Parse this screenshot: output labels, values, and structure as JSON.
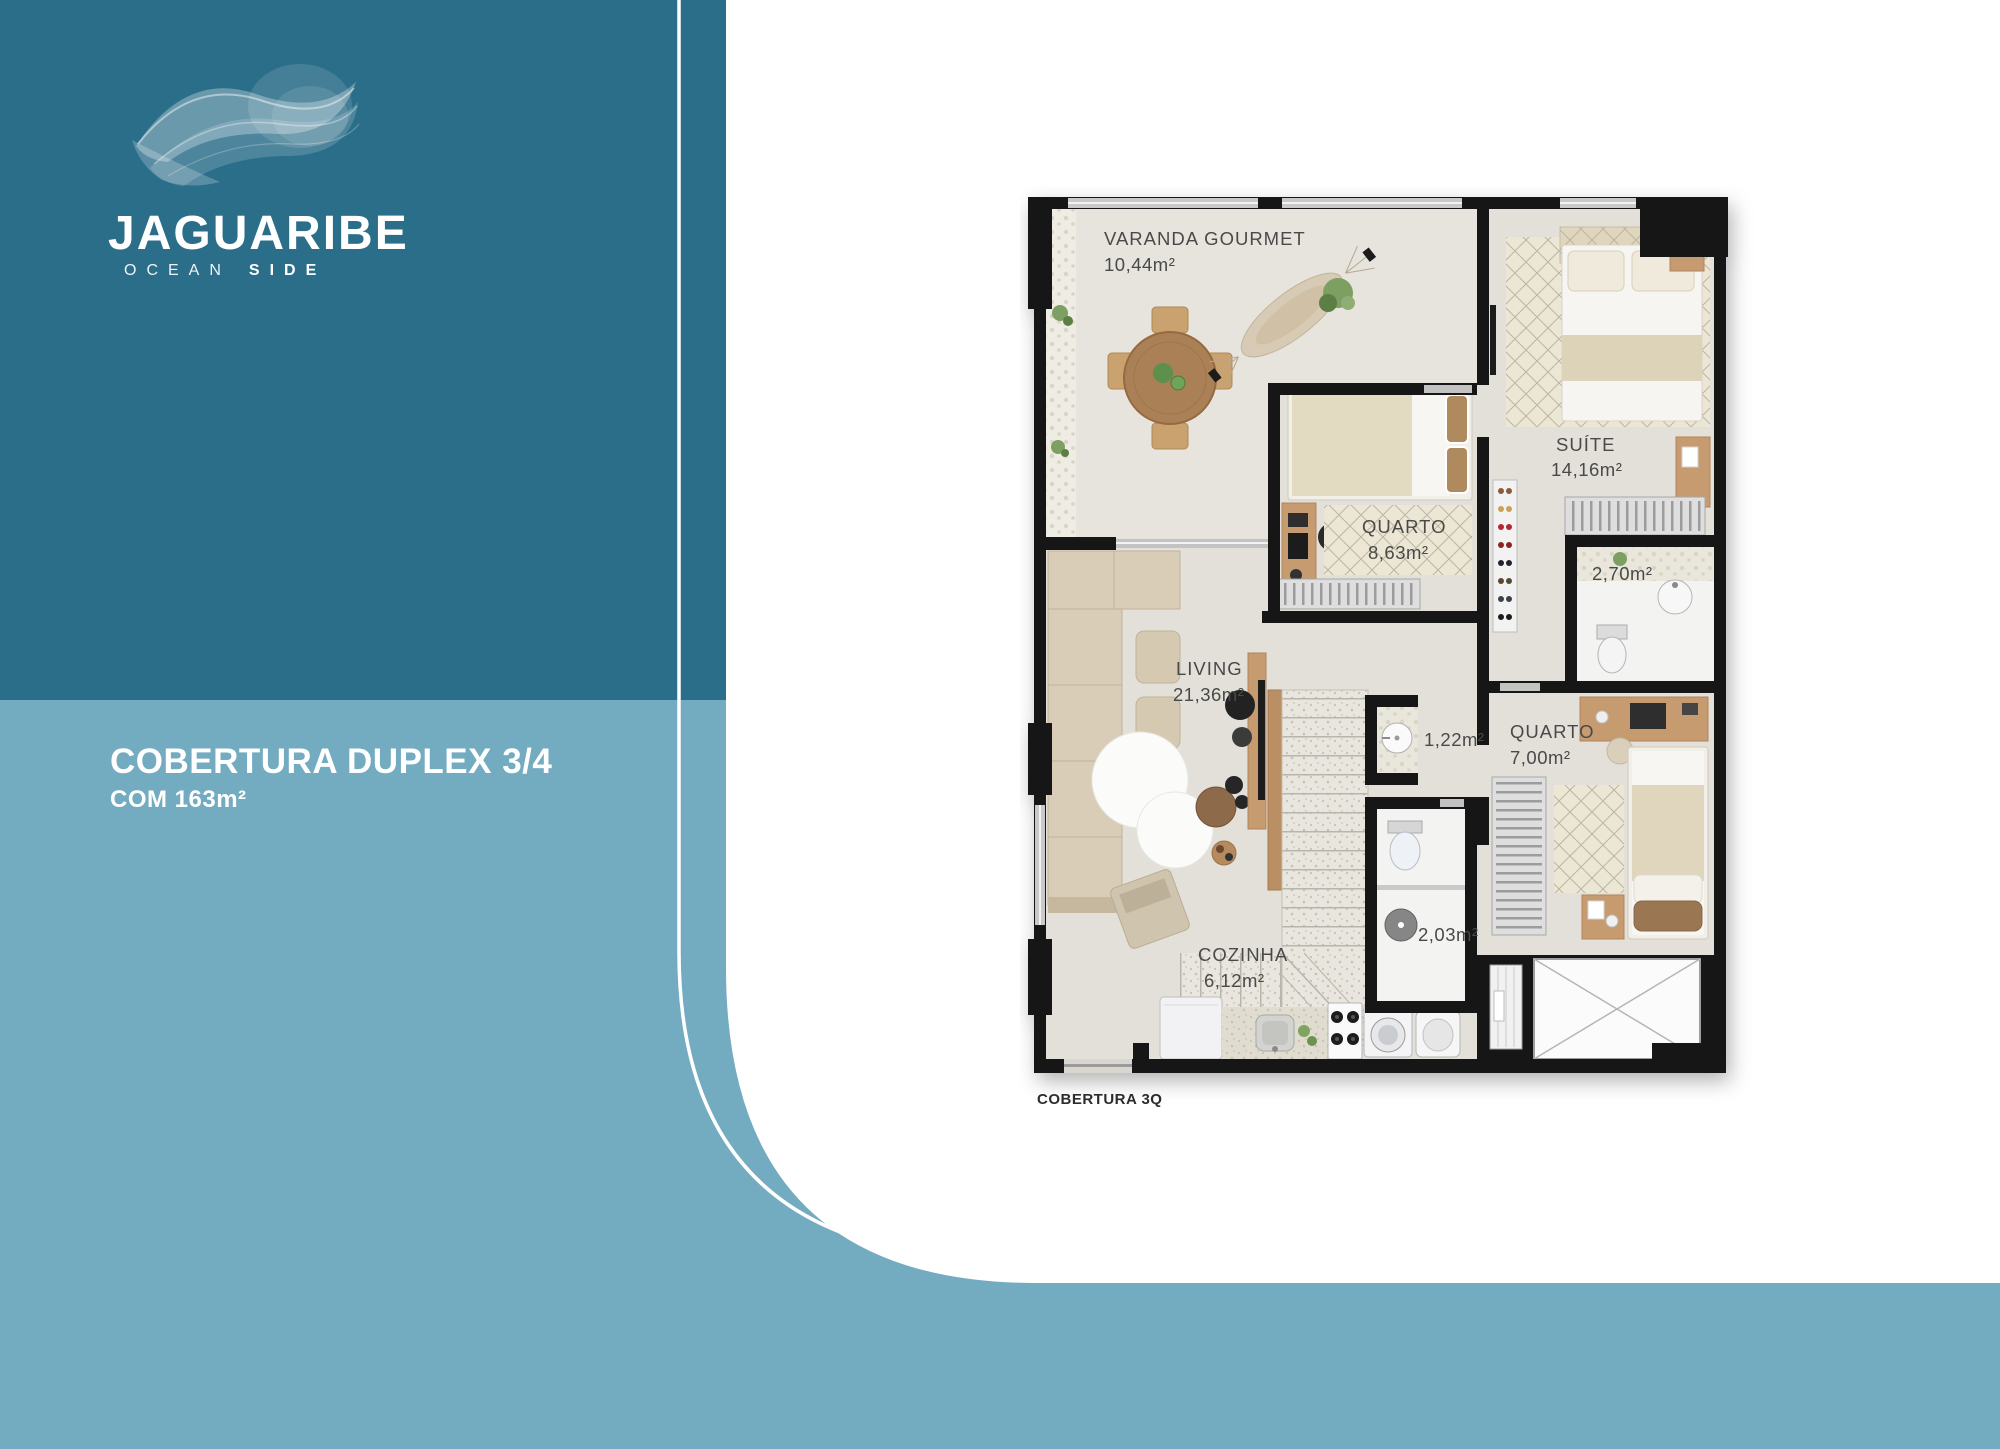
{
  "brand": {
    "name": "JAGUARIBE",
    "tagline": {
      "word1": "OCEAN",
      "word2": "SIDE"
    }
  },
  "panel": {
    "title_line1": "COBERTURA DUPLEX 3/4",
    "title_line2": "COM 163m²"
  },
  "colors": {
    "panel_dark": "#2b6e89",
    "panel_light": "#73abc0",
    "wall": "#161616",
    "floor": "#e3e0da",
    "label_text": "#4a4a4a"
  },
  "floorplan": {
    "caption": "COBERTURA 3Q",
    "rooms": [
      {
        "name": "VARANDA GOURMET",
        "area": "10,44m²"
      },
      {
        "name": "QUARTO",
        "area": "8,63m²"
      },
      {
        "name": "SUÍTE",
        "area": "14,16m²"
      },
      {
        "name": "",
        "area": "2,70m²"
      },
      {
        "name": "LIVING",
        "area": "21,36m²"
      },
      {
        "name": "",
        "area": "1,22m²"
      },
      {
        "name": "QUARTO",
        "area": "7,00m²"
      },
      {
        "name": "",
        "area": "2,03m²"
      },
      {
        "name": "COZINHA",
        "area": "6,12m²"
      }
    ]
  }
}
